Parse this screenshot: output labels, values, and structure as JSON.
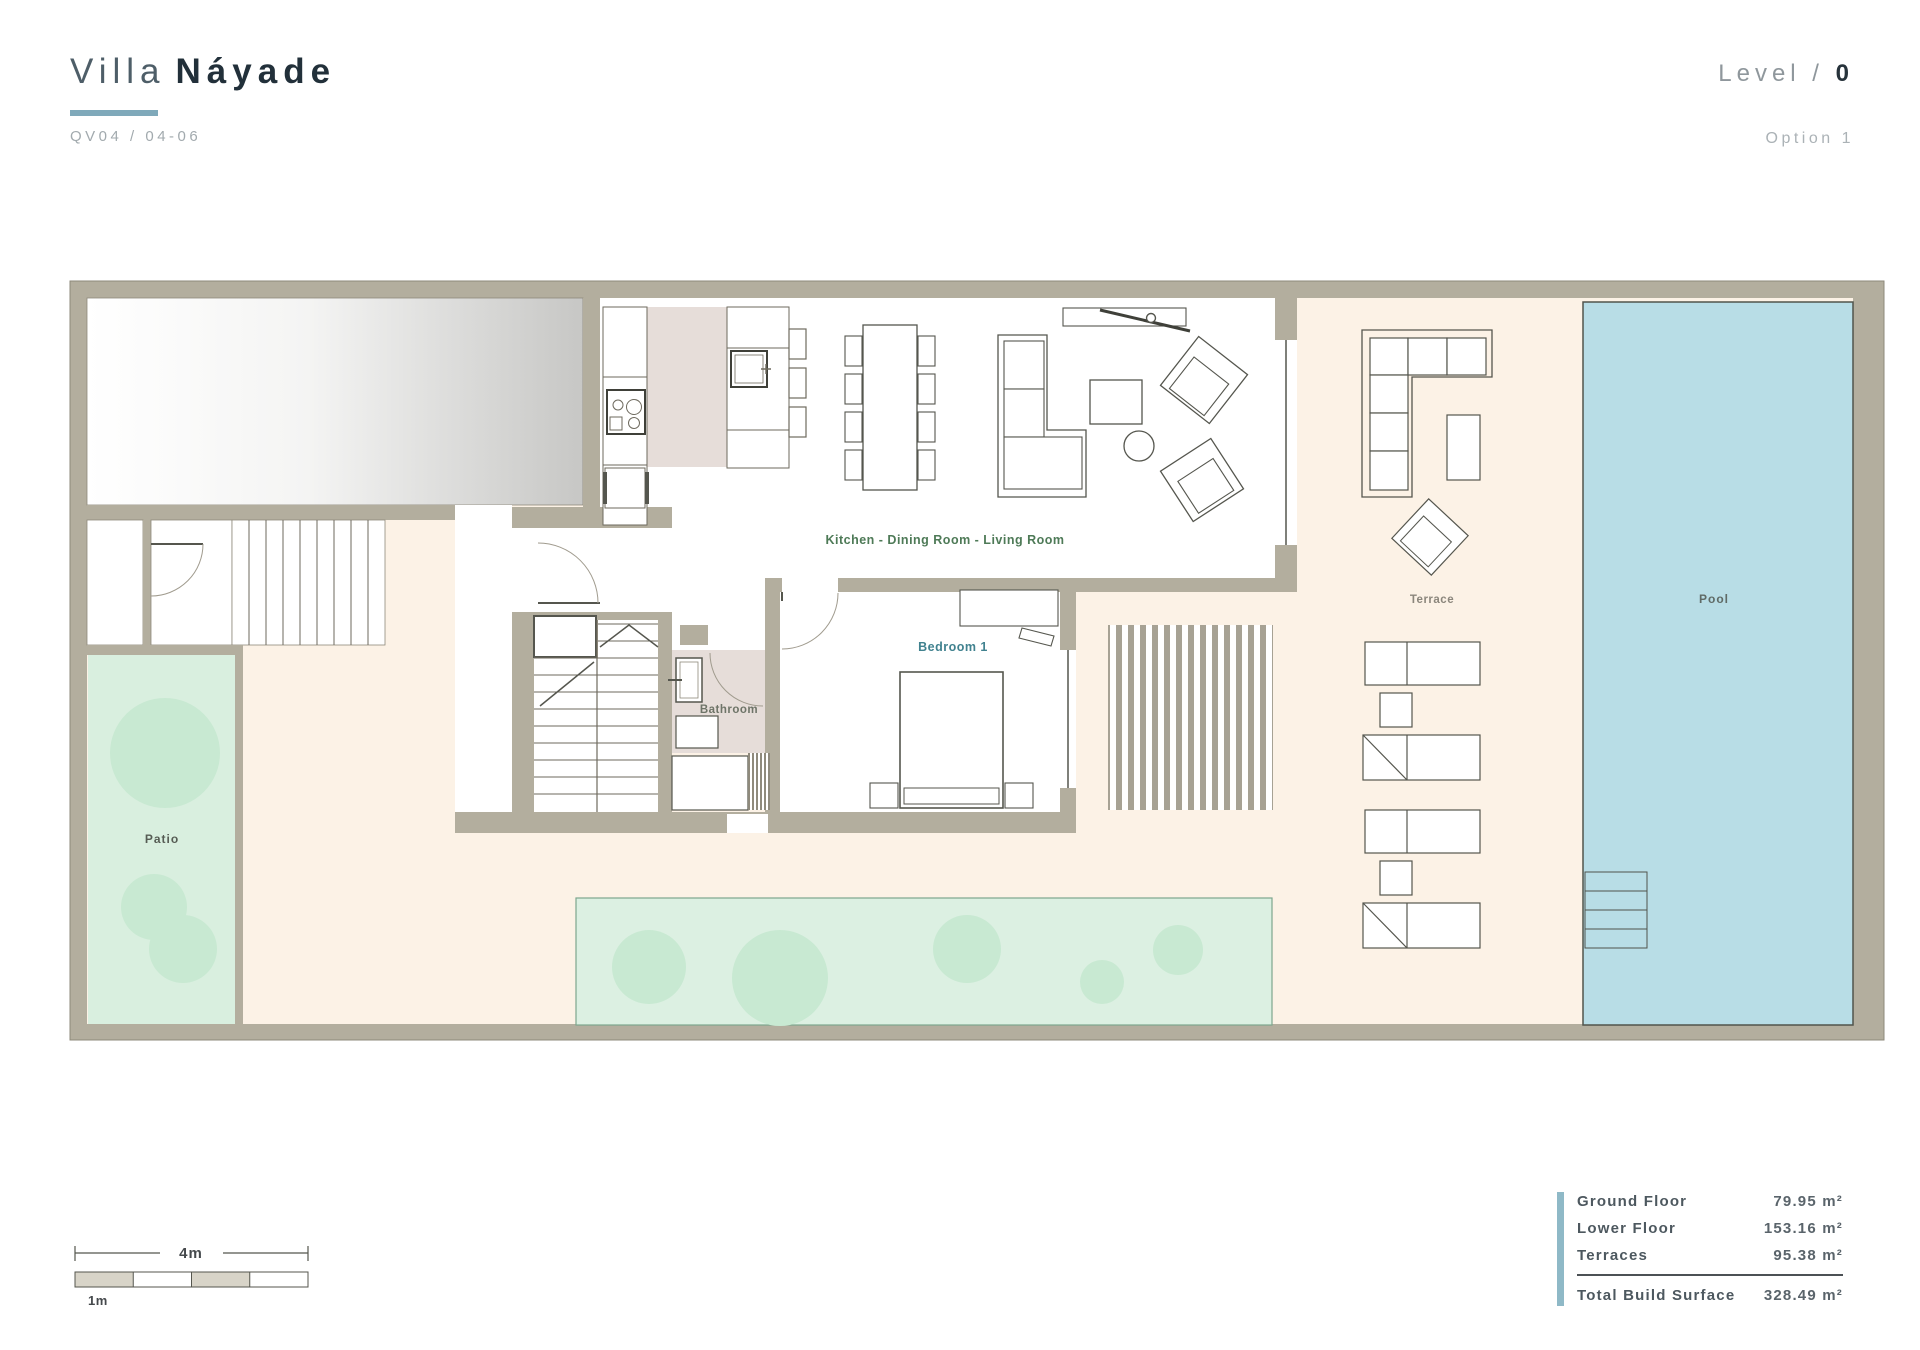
{
  "header": {
    "title_light": "Villa",
    "title_bold": "Náyade",
    "project_code": "QV04 / 04-06",
    "level_label": "Level /",
    "level_value": "0",
    "option_label": "Option 1"
  },
  "plan": {
    "rooms": {
      "kitchen_living": "Kitchen - Dining Room - Living Room",
      "bedroom": "Bedroom 1",
      "bathroom": "Bathroom",
      "terrace": "Terrace",
      "pool": "Pool",
      "patio": "Patio"
    }
  },
  "scale_bar": {
    "total_label": "4m",
    "unit_label": "1m"
  },
  "areas_table": {
    "rows": [
      {
        "label": "Ground Floor",
        "value": "79.95 m²"
      },
      {
        "label": "Lower Floor",
        "value": "153.16 m²"
      },
      {
        "label": "Terraces",
        "value": "95.38 m²"
      }
    ],
    "total": {
      "label": "Total Build Surface",
      "value": "328.49 m²"
    }
  },
  "colors": {
    "accent_underline": "#7fa9ba",
    "accent_bar": "#8fb9c7",
    "wall": "#b3ae9e",
    "floor_cream": "#fcf2e6",
    "pool_blue": "#b8dde6",
    "patio_green": "#d9efdf",
    "vegetation_green": "#c8e9d2",
    "interior_tile": "#e6ddd9",
    "kitchen_label_green": "#4e7a57",
    "bedroom_label_teal": "#41828f"
  }
}
